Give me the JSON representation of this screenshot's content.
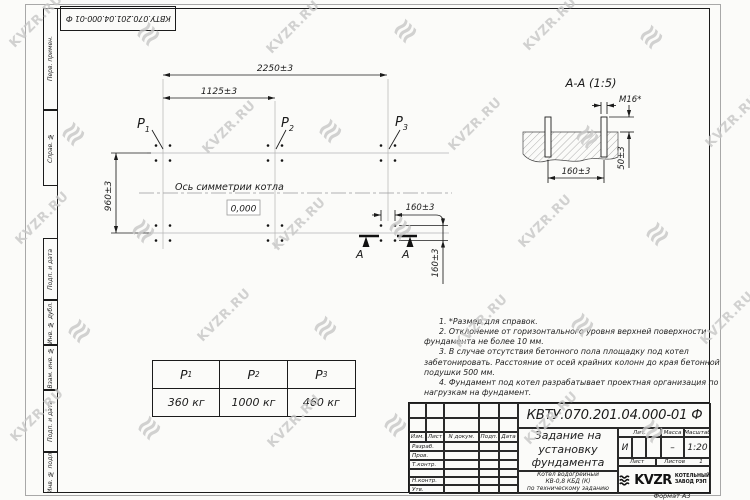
{
  "watermark": {
    "text": "KVZR.RU",
    "glyph": "≋"
  },
  "top_stamp": "КВТУ.070.201.04.000-01 Ф",
  "side_column": [
    "Перв. примен.",
    "Справ. №",
    "Подп. и дата",
    "Инв. № дубл.",
    "Взам. инв. №",
    "Подп. и дата",
    "Инв. № подл."
  ],
  "plan": {
    "dim_top": "2250±3",
    "dim_half": "1125±3",
    "dim_side": "960±3",
    "dim_bolt_h": "160±3",
    "dim_bolt_v": "160±3",
    "p1": {
      "label": "P",
      "sub": "1"
    },
    "p2": {
      "label": "P",
      "sub": "2"
    },
    "p3": {
      "label": "P",
      "sub": "3"
    },
    "axis_label": "Ось симметрии котла",
    "level_mark": "0,000",
    "section_letter": "А"
  },
  "section": {
    "title": "А-А (1:5)",
    "dim_thread": "М16*",
    "dim_height": "50±3",
    "dim_spacing": "160±3"
  },
  "notes": [
    "1. *Размер для справок.",
    "2. Отклонение от горизонтального уровня верхней поверхности фундамента не более 10 мм.",
    "3. В случае отсутствия бетонного пола площадку под котел забетонировать. Расстояние от осей крайних колонн до края бетонной подушки 500 мм.",
    "4. Фундамент под котел разрабатывает проектная организация по нагрузкам на фундамент."
  ],
  "loads_table": {
    "headers": [
      {
        "label": "P",
        "sub": "1"
      },
      {
        "label": "P",
        "sub": "2"
      },
      {
        "label": "P",
        "sub": "3"
      }
    ],
    "values": [
      "360 кг",
      "1000 кг",
      "460 кг"
    ]
  },
  "title_block": {
    "doc_number": "КВТУ.070.201.04.000-01 Ф",
    "title_lines": [
      "Задание на",
      "установку",
      "фундамента"
    ],
    "product_lines": [
      "Котел водогрейный",
      "КВ-0,8 КБД (К)",
      "по техническому заданию"
    ],
    "rev_headers": [
      "Изм.",
      "Лист",
      "N докум.",
      "Подп.",
      "Дата"
    ],
    "sig_rows": [
      "Разраб.",
      "Пров.",
      "Т.контр.",
      "",
      "Н.контр.",
      "Утв."
    ],
    "lit_label": "Лит.",
    "lit_value": "И",
    "mass_label": "Масса",
    "mass_value": "–",
    "scale_label": "Масштаб",
    "scale_value": "1:20",
    "sheet_label": "Лист",
    "sheets_label": "Листов",
    "sheets_value": "1",
    "logo_text": "KVZR",
    "logo_caption_lines": [
      "КОТЕЛЬНЫЙ",
      "ЗАВОД РЭП"
    ],
    "format_label": "Формат А3"
  }
}
